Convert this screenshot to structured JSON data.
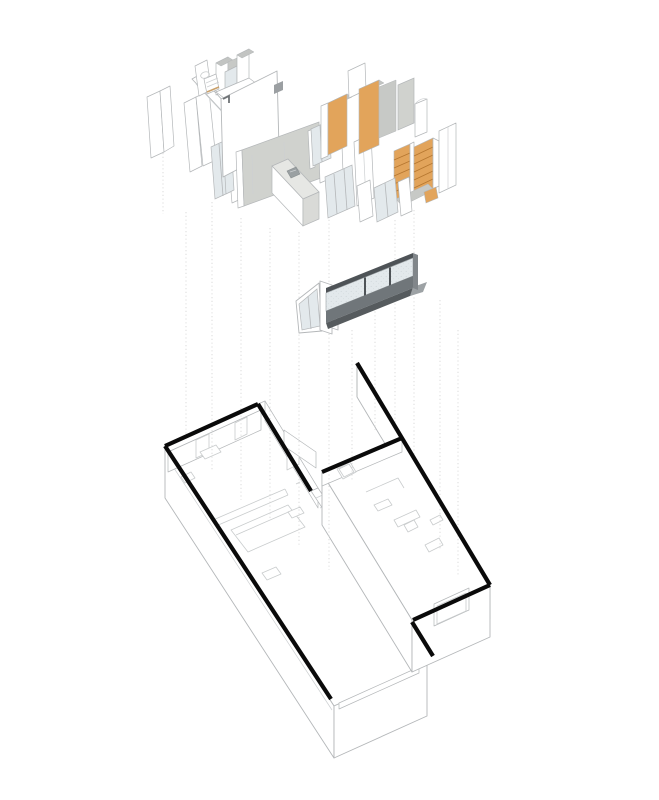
{
  "diagram": {
    "type": "exploded-axonometric",
    "subject": "Apartment renovation exploded isometric: interior fit-out layer above, glazed window band in middle, structural shell floor plan below",
    "layers": [
      {
        "name": "interior-fitout",
        "description": "bathroom pod, louvered walls, concrete feature wall, kitchen island, timber wardrobes and shelving"
      },
      {
        "name": "glazing-band",
        "description": "dark-framed ribbon window with three panes and a glazed entry door"
      },
      {
        "name": "structural-shell",
        "description": "two offset rectangular bars with heavy black plan walls, linking courtyard, fascia window openings"
      }
    ],
    "projection_guides": {
      "style": "vertical-dotted",
      "count": 13
    }
  },
  "colors": {
    "background": "#ffffff",
    "wood": "#e2a45b",
    "wood_shelf": "#b5762f",
    "concrete": "#d0d2ce",
    "concrete_dark": "#c7c9c6",
    "glass": "#e3e9ec",
    "frame_dark": "#4e5357",
    "spandrel": "#70767a",
    "sill_dark": "#565b5e",
    "sill_light": "#9da2a5",
    "metal_mid": "#81868a",
    "outline": "#b4b7b9",
    "outline_light": "#cdd0d2",
    "furniture_line": "#c9cccd",
    "wall_black": "#0a0a0a",
    "guide": "#d8d8d8",
    "cap_gray": "#c2c4c2",
    "counter": "#e6e7e4",
    "island_side": "#d9dad7",
    "sink": "#9aa0a2",
    "tan_accent": "#c9a06b"
  }
}
